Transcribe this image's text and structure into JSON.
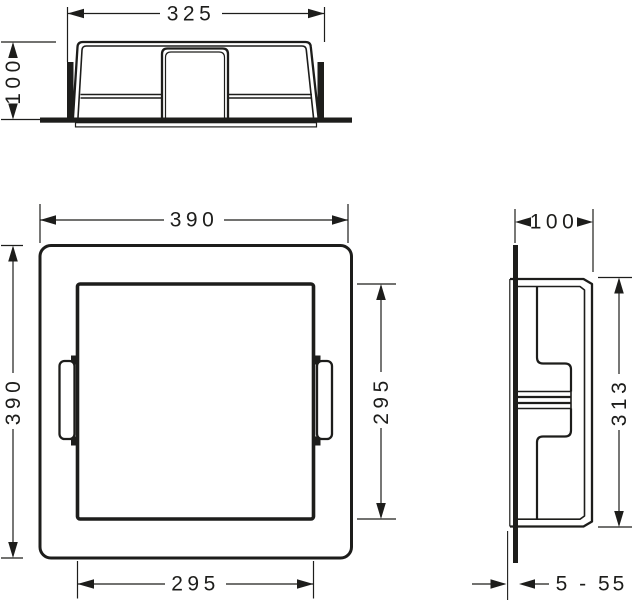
{
  "drawing": {
    "kind": "technical-dimension-drawing",
    "background": "#ffffff",
    "line_color": "#1d1d1b",
    "views": {
      "top": {
        "dim_width": "325",
        "dim_depth": "100"
      },
      "front": {
        "dim_width": "390",
        "dim_height": "390",
        "dim_inner_width": "295",
        "dim_inner_height": "295"
      },
      "side": {
        "dim_depth": "100",
        "dim_height": "313",
        "dim_tile_range": "5 - 55"
      }
    }
  }
}
